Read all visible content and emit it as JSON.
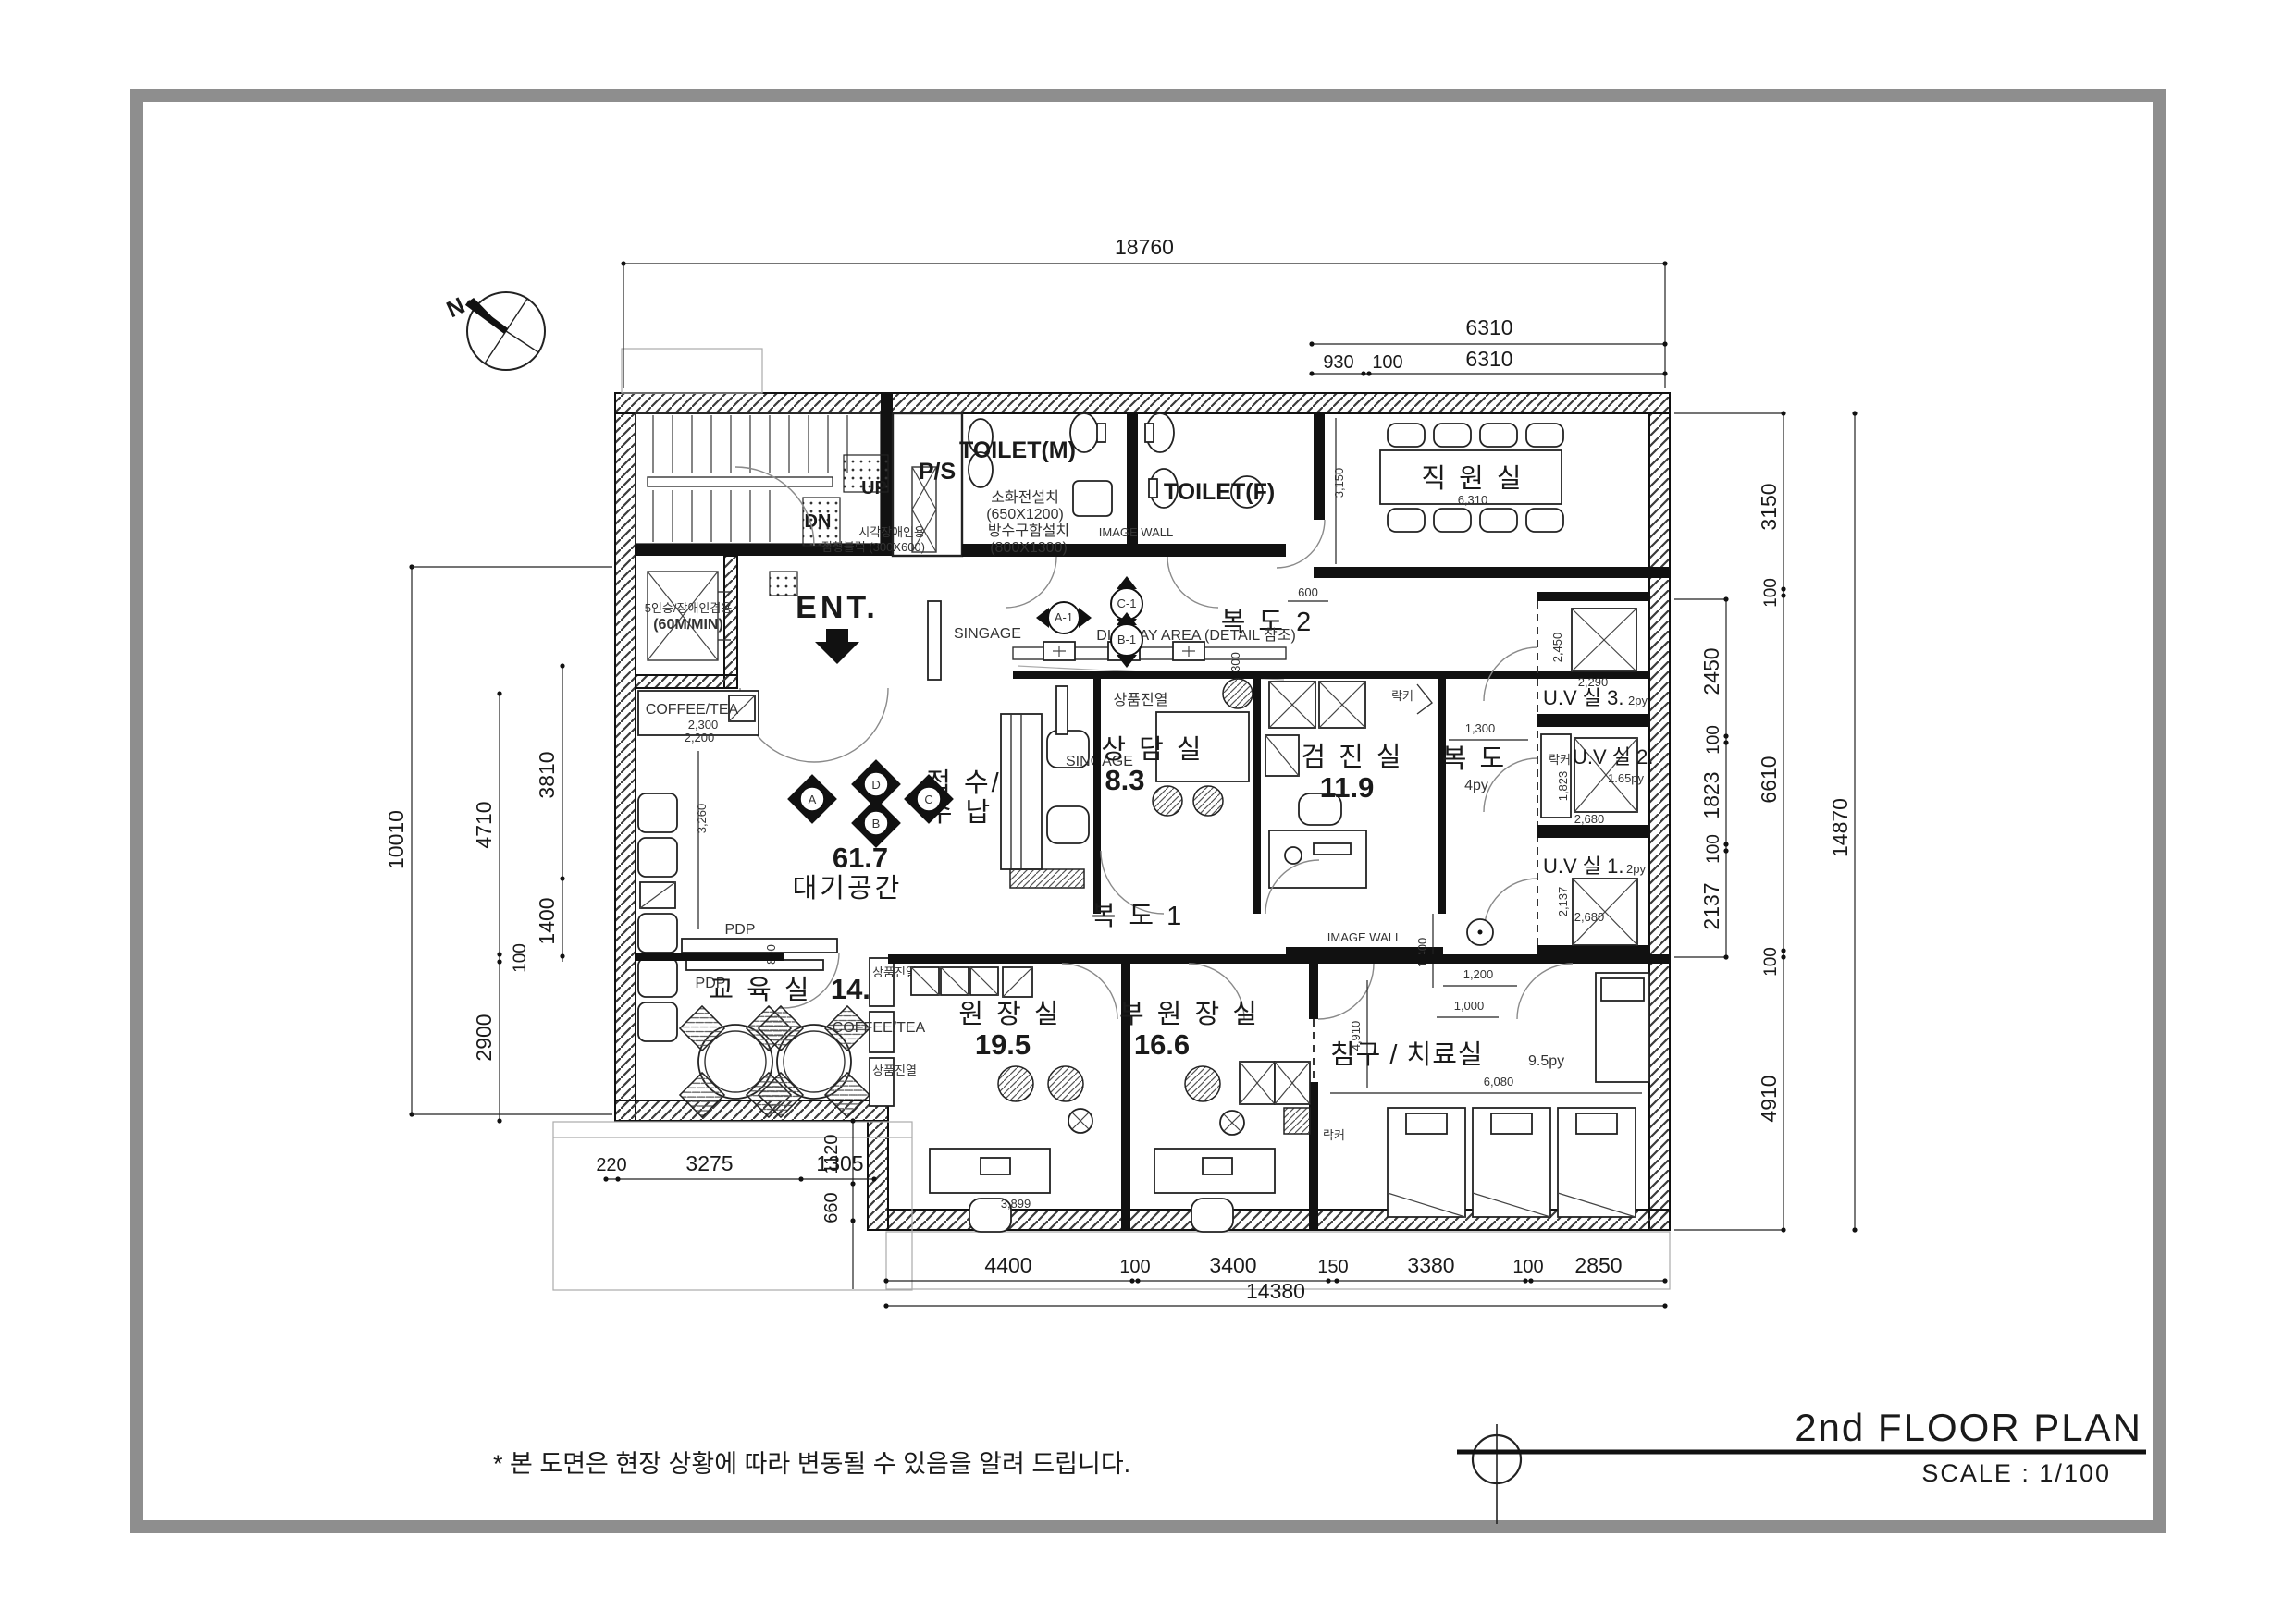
{
  "page": {
    "title": "2nd FLOOR PLAN",
    "scale_label": "SCALE :  1/100",
    "footnote": "* 본 도면은 현장 상황에 따라 변동될 수 있음을 알려 드립니다.",
    "north_label": "N",
    "ink_color": "#1a1a1a",
    "frame_color": "#8e8e8e"
  },
  "rooms": {
    "staff": {
      "name": "직 원 실",
      "width_dim": "6,310",
      "height_dim": "3,150"
    },
    "corridor2": {
      "name": "복 도 2"
    },
    "corridor1": {
      "name": "복 도 1"
    },
    "corridor_mid": {
      "name": "복 도",
      "area": "4py",
      "width_dim": "1,300"
    },
    "waiting": {
      "area": "61.7",
      "name": "대기공간",
      "sofa_dim": "3,260",
      "pdp_gap_dim": "800"
    },
    "reception": {
      "line1": "접 수/",
      "line2": "수 납"
    },
    "consult": {
      "name": "상 담 실",
      "area": "8.3"
    },
    "exam": {
      "name": "검 진 실",
      "area": "11.9"
    },
    "uv3": {
      "name": "U.V 실  3.",
      "area": "2py",
      "height_dim": "2,450",
      "width_dim": "2,290"
    },
    "uv2": {
      "name": "U.V 실  2.",
      "area": "1.65py",
      "height_dim": "1,823",
      "width_dim": "2,680"
    },
    "uv1": {
      "name": "U.V 실  1.",
      "area": "2py",
      "height_dim": "2,137",
      "width_dim": "2,680"
    },
    "education": {
      "name": "교 육 실",
      "area": "14.3"
    },
    "director": {
      "name": "원 장 실",
      "area": "19.5",
      "desk_dim": "3,899"
    },
    "vice_director": {
      "name": "부 원 장 실",
      "area": "16.6"
    },
    "treatment": {
      "name": "침구 / 치료실",
      "area": "9.5py",
      "width_dim": "6,080",
      "height_dim": "4,910"
    },
    "toilet_m": {
      "name": "TOILET(M)"
    },
    "toilet_f": {
      "name": "TOILET(F)"
    },
    "ps": {
      "name": "P/S"
    },
    "elevator": {
      "line1": "5인승/장애인겸용",
      "line2": "(60M/MIN)"
    }
  },
  "annotations": {
    "ent": "ENT.",
    "up": "UP",
    "dn": "DN",
    "signage_lobby": "SINGAGE",
    "signage_reception": "SINGAGE",
    "image_wall_toilet": "IMAGE WALL",
    "image_wall_corridor": "IMAGE WALL",
    "display_area": "DISPLAY AREA (DETAIL 참조)",
    "display_area_dim": "300",
    "shelf_display1": "상품진열",
    "shelf_display2": "상품진열",
    "shelf_display3": "상품진열",
    "coffee_tea_waiting": "COFFEE/TEA",
    "coffee_tea_dim1": "2,300",
    "coffee_tea_dim2": "2,200",
    "coffee_tea_education": "COFFEE/TEA",
    "pdp1": "PDP",
    "pdp2": "PDP",
    "fire_hydrant": "소화전설치",
    "fire_hydrant_size": "(650X1200)",
    "waterproof_box": "방수구함설치",
    "waterproof_box_size": "(800X1300)",
    "braille_line1": "시각장애인용",
    "braille_line2": "점형블럭  (300X600)",
    "locker_exam": "락커",
    "locker_uv2": "락커",
    "locker_vice": "락커",
    "offset_600": "600",
    "corridor_dim_1400": "1,400",
    "corridor_dim_1200": "1,200",
    "corridor_dim_1000": "1,000"
  },
  "markers": {
    "a": "A",
    "b": "B",
    "c": "C",
    "d": "D",
    "a1": "A-1",
    "b1": "B-1",
    "c1": "C-1"
  },
  "dimensions": {
    "top_total": "18760",
    "top_6310_a": "6310",
    "top_6310_b": "6310",
    "top_930": "930",
    "top_100": "100",
    "left_10010": "10010",
    "left_4710": "4710",
    "left_3810": "3810",
    "left_1400": "1400",
    "left_100": "100",
    "left_2900": "2900",
    "bl_220": "220",
    "bl_3275": "3275",
    "bl_1120": "1120",
    "bl_1305": "1305",
    "bl_660": "660",
    "bottom_4400": "4400",
    "bottom_100_a": "100",
    "bottom_3400": "3400",
    "bottom_150": "150",
    "bottom_3380": "3380",
    "bottom_100_b": "100",
    "bottom_2850": "2850",
    "bottom_total": "14380",
    "right_3150": "3150",
    "right_100_a": "100",
    "right_2450": "2450",
    "right_100_b": "100",
    "right_1823": "1823",
    "right_100_c": "100",
    "right_2137": "2137",
    "right_100_d": "100",
    "right_6610": "6610",
    "right_4910": "4910",
    "right_14870": "14870"
  }
}
